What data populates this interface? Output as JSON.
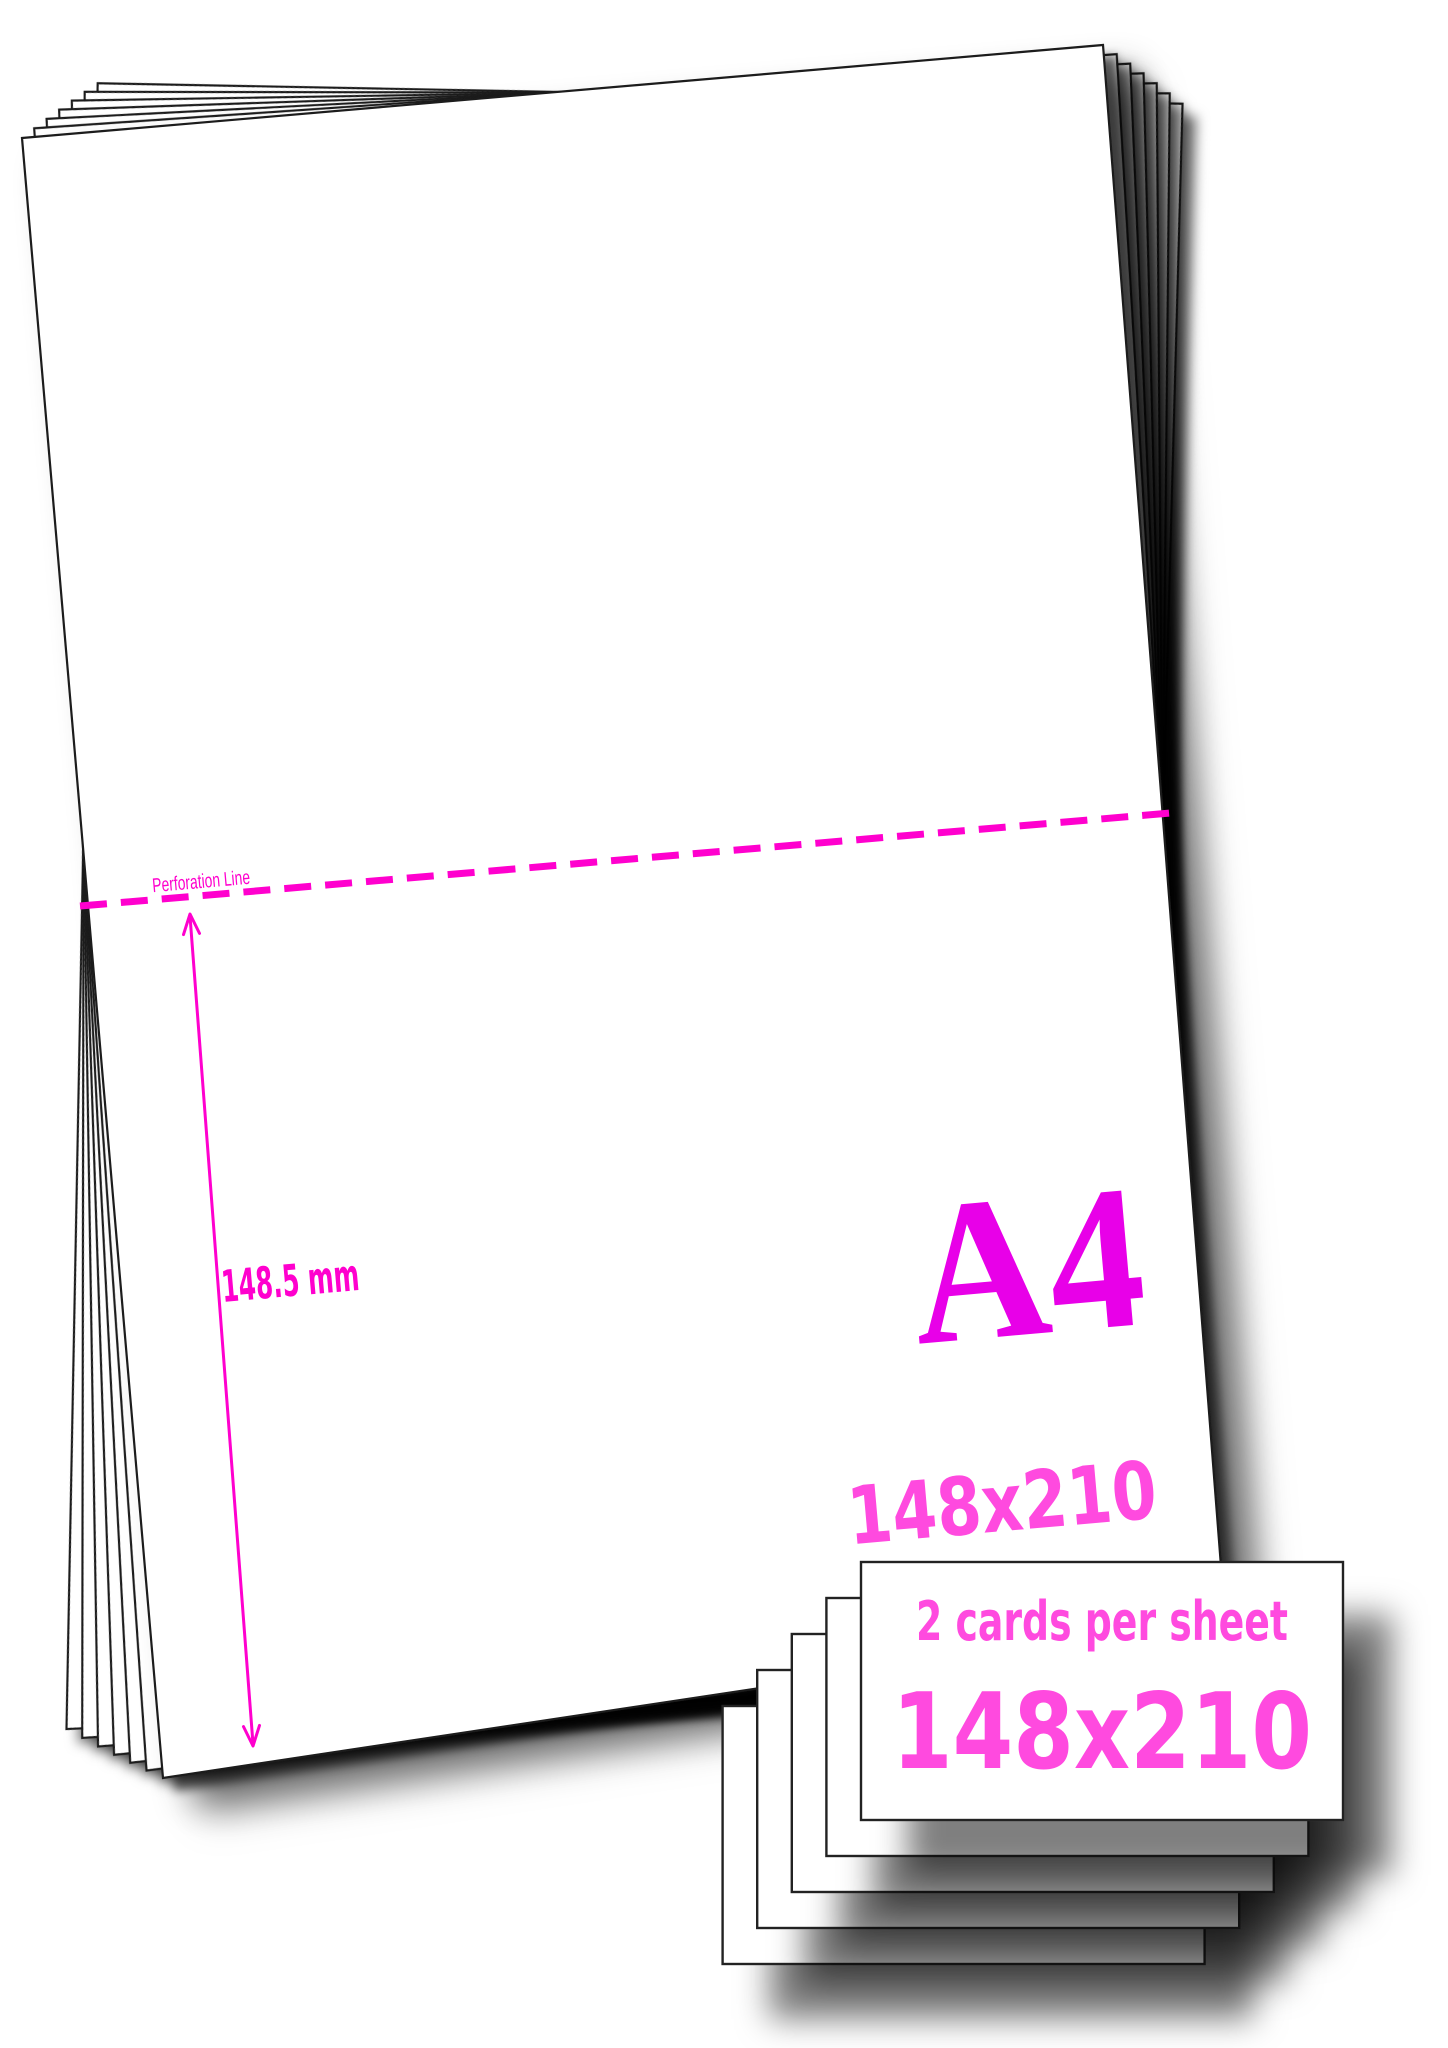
{
  "sheet": {
    "format_label": "A4",
    "dimensions_label": "148x210",
    "perforation_label": "Perforation Line",
    "measurement_label": "148.5 mm"
  },
  "cards": {
    "per_sheet_label": "2 cards per sheet",
    "dimensions_label": "148x210",
    "visible_count": 5
  },
  "colors": {
    "magenta": "#FF00CE",
    "a4_magenta": "#E800E8",
    "pink": "#FF4ADF",
    "paper": "#FFFFFF",
    "edge": "#1A1A1A"
  }
}
